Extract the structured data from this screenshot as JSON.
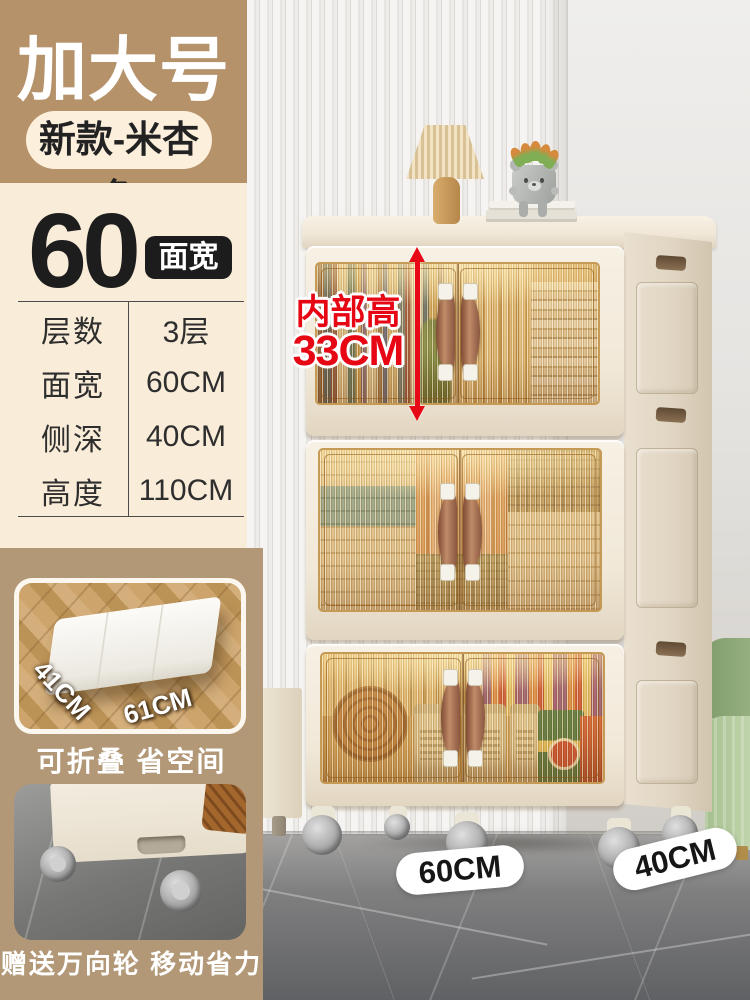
{
  "header": {
    "title": "加大号",
    "variant_pill": "新款-米杏色"
  },
  "size": {
    "number": "60",
    "badge": "面宽"
  },
  "specs": [
    {
      "label": "层数",
      "value": "3层"
    },
    {
      "label": "面宽",
      "value": "60CM"
    },
    {
      "label": "侧深",
      "value": "40CM"
    },
    {
      "label": "高度",
      "value": "110CM"
    }
  ],
  "fold_card": {
    "depth_label": "41CM",
    "width_label": "61CM",
    "caption": "可折叠 省空间"
  },
  "wheels_card": {
    "caption": "赠送万向轮 移动省力"
  },
  "inner_height": {
    "line1": "内部高",
    "line2": "33CM"
  },
  "floor_labels": {
    "width": "60CM",
    "depth": "40CM"
  },
  "product": {
    "tier_count": 3,
    "tiers": [
      "books",
      "rolled-textiles",
      "snacks"
    ]
  },
  "colors": {
    "tan_header": "#b5926a",
    "tan_lower": "#b29877",
    "cream_panel": "#f9ecd9",
    "pill_cream": "#fcf0dd",
    "badge_black": "#1c1c1c",
    "accent_red": "#e60614",
    "cabinet_cream": "#f1e8da",
    "door_amber": "#caa05e",
    "handle_brown": "#a5714f"
  }
}
